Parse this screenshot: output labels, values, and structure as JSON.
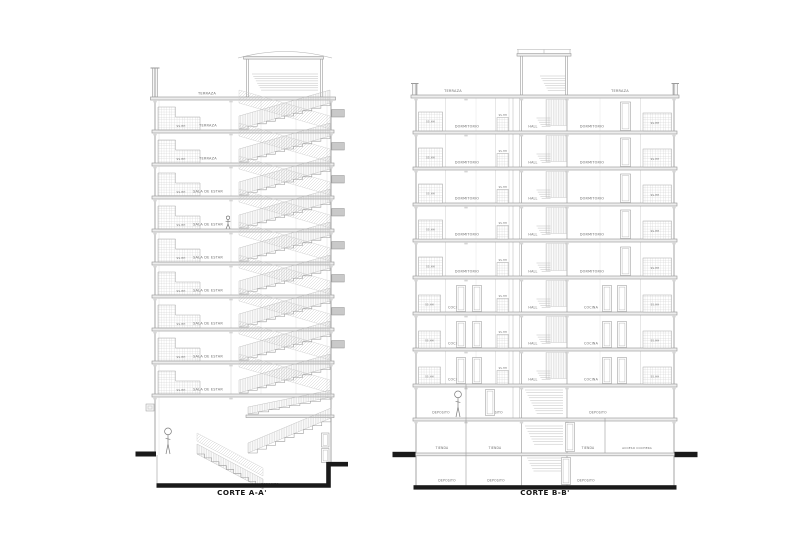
{
  "captions": {
    "left": "CORTE A-A'",
    "right": "CORTE B-B'"
  },
  "left_section": {
    "roof_label": "TERRAZA",
    "floor_labels": [
      "TERRAZA",
      "TERRAZA",
      "SALA DE ESTAR",
      "SALA DE ESTAR",
      "SALA DE ESTAR",
      "SALA DE ESTAR",
      "SALA DE ESTAR",
      "SALA DE ESTAR",
      "SALA DE ESTAR"
    ],
    "bath_label": "SS.HH",
    "basement_label": "DEPOSITO"
  },
  "right_section": {
    "roof_label_left": "TERRAZA",
    "roof_label_right": "TERRAZA",
    "upper_floors": [
      {
        "left": "DORMITORIO",
        "hall": "HALL",
        "right": "DORMITORIO"
      },
      {
        "left": "DORMITORIO",
        "hall": "HALL",
        "right": "DORMITORIO"
      },
      {
        "left": "DORMITORIO",
        "hall": "HALL",
        "right": "DORMITORIO"
      },
      {
        "left": "DORMITORIO",
        "hall": "HALL",
        "right": "DORMITORIO"
      },
      {
        "left": "DORMITORIO",
        "hall": "HALL",
        "right": "DORMITORIO"
      }
    ],
    "lower_floors": [
      {
        "left": "COCINA",
        "hall": "HALL",
        "right": "COCINA"
      },
      {
        "left": "COCINA",
        "hall": "HALL",
        "right": "COCINA"
      },
      {
        "left": "COCINA",
        "hall": "HALL",
        "right": "COCINA"
      }
    ],
    "bath_label": "SS.HH",
    "mezzanine_labels": [
      "DEPOSITO",
      "DEPOSITO",
      "DEPOSITO"
    ],
    "ground_labels": [
      "TIENDA",
      "TIENDA",
      "TIENDA"
    ],
    "garage_label": "ACCESO COCHERA",
    "basement_labels": [
      "DEPOSITO",
      "DEPOSITO",
      "DEPOSITO"
    ]
  },
  "colors": {
    "line": "#9b9b9b",
    "line_light": "#cfcfcf",
    "slab_fill": "#ededed",
    "black": "#1a1a1a",
    "label": "#6d6d6d",
    "window_fill": "#c9c9c9"
  }
}
